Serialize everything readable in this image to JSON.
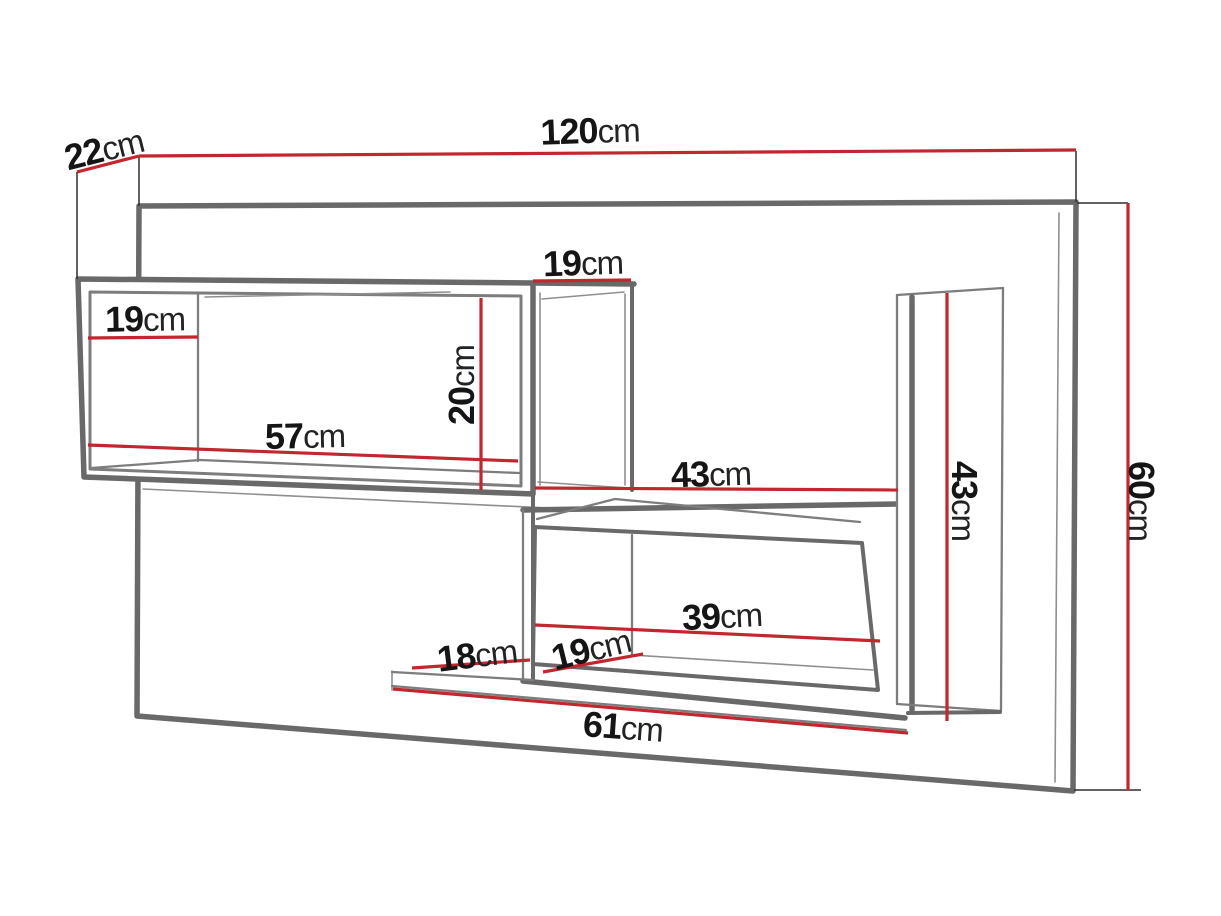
{
  "colors": {
    "background": "#ffffff",
    "dimension_line": "#c2262e",
    "extension_line": "#2e2e2e",
    "structure_dark": "#696969",
    "structure_mid": "#7d7d7d",
    "structure_light": "#8f8f8f",
    "label_text": "#151515"
  },
  "dimensions": {
    "unit": "cm",
    "labels": [
      {
        "id": "panel-top-depth",
        "value": "22",
        "unit": "cm"
      },
      {
        "id": "overall-width",
        "value": "120",
        "unit": "cm"
      },
      {
        "id": "upper-middle-compartment-width",
        "value": "19",
        "unit": "cm"
      },
      {
        "id": "upper-left-compartment-depth",
        "value": "19",
        "unit": "cm"
      },
      {
        "id": "upper-compartment-interior-height",
        "value": "20",
        "unit": "cm"
      },
      {
        "id": "upper-compartment-interior-width",
        "value": "57",
        "unit": "cm"
      },
      {
        "id": "middle-opening-width",
        "value": "43",
        "unit": "cm"
      },
      {
        "id": "right-compartment-height",
        "value": "43",
        "unit": "cm"
      },
      {
        "id": "overall-height",
        "value": "60",
        "unit": "cm"
      },
      {
        "id": "lower-compartment-interior-width",
        "value": "39",
        "unit": "cm"
      },
      {
        "id": "lower-compartment-depth",
        "value": "19",
        "unit": "cm"
      },
      {
        "id": "bottom-shelf-depth",
        "value": "18",
        "unit": "cm"
      },
      {
        "id": "bottom-shelf-width",
        "value": "61",
        "unit": "cm"
      }
    ]
  }
}
